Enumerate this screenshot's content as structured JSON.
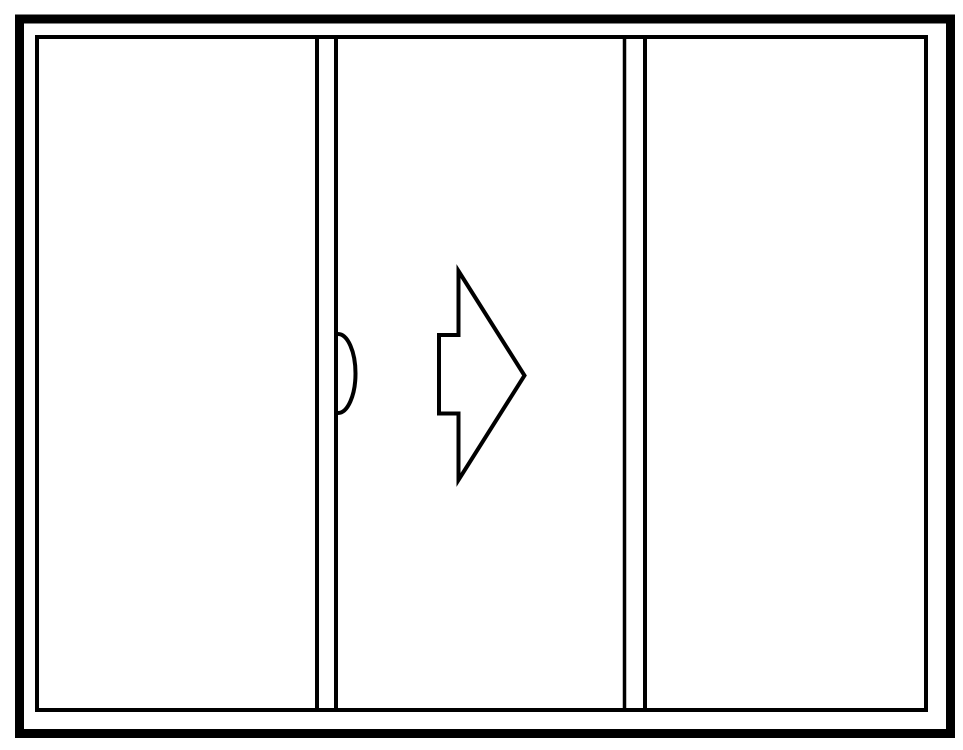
{
  "page": {
    "background_color": "#ffffff"
  },
  "diagram": {
    "kind": "three-panel-sliding-door-elevation",
    "slide_direction": "right",
    "stroke_color": "#000000",
    "panel_fill": "#ffffff",
    "panel_count": 3,
    "canvas": {
      "width": 963,
      "height": 750
    },
    "shapes": [
      {
        "name": "outer-frame",
        "tag": "rect",
        "attrs": {
          "x": 19.5,
          "y": 19,
          "width": 931,
          "height": 714.5,
          "fill": "none",
          "stroke": "#000000",
          "stroke-width": 9
        }
      },
      {
        "name": "inner-frame",
        "tag": "rect",
        "attrs": {
          "x": 37,
          "y": 37,
          "width": 889,
          "height": 673,
          "fill": "none",
          "stroke": "#000000",
          "stroke-width": 4
        }
      },
      {
        "name": "middle-stile-left-line",
        "tag": "line",
        "attrs": {
          "x1": 317,
          "y1": 37,
          "x2": 317,
          "y2": 710,
          "stroke": "#000000",
          "stroke-width": 4
        }
      },
      {
        "name": "middle-stile-right-line",
        "tag": "line",
        "attrs": {
          "x1": 336,
          "y1": 37,
          "x2": 336,
          "y2": 710,
          "stroke": "#000000",
          "stroke-width": 4
        }
      },
      {
        "name": "right-stile-left-line",
        "tag": "line",
        "attrs": {
          "x1": 624.5,
          "y1": 37,
          "x2": 624.5,
          "y2": 710,
          "stroke": "#000000",
          "stroke-width": 3.5
        }
      },
      {
        "name": "right-stile-right-line",
        "tag": "line",
        "attrs": {
          "x1": 645,
          "y1": 37,
          "x2": 645,
          "y2": 710,
          "stroke": "#000000",
          "stroke-width": 4
        }
      },
      {
        "name": "door-handle-arc",
        "tag": "path",
        "attrs": {
          "d": "M 338 334 A 17.5 39.5 0 0 1 338 413",
          "fill": "none",
          "stroke": "#000000",
          "stroke-width": 4
        }
      },
      {
        "name": "slide-direction-arrow",
        "tag": "path",
        "attrs": {
          "d": "M 458.5 271 L 524.5 375.5 L 458.5 480 L 458.5 413.5 L 439 413.5 L 439 335 L 458.5 335 Z",
          "fill": "#ffffff",
          "stroke": "#000000",
          "stroke-width": 4,
          "stroke-linejoin": "miter"
        }
      }
    ]
  }
}
